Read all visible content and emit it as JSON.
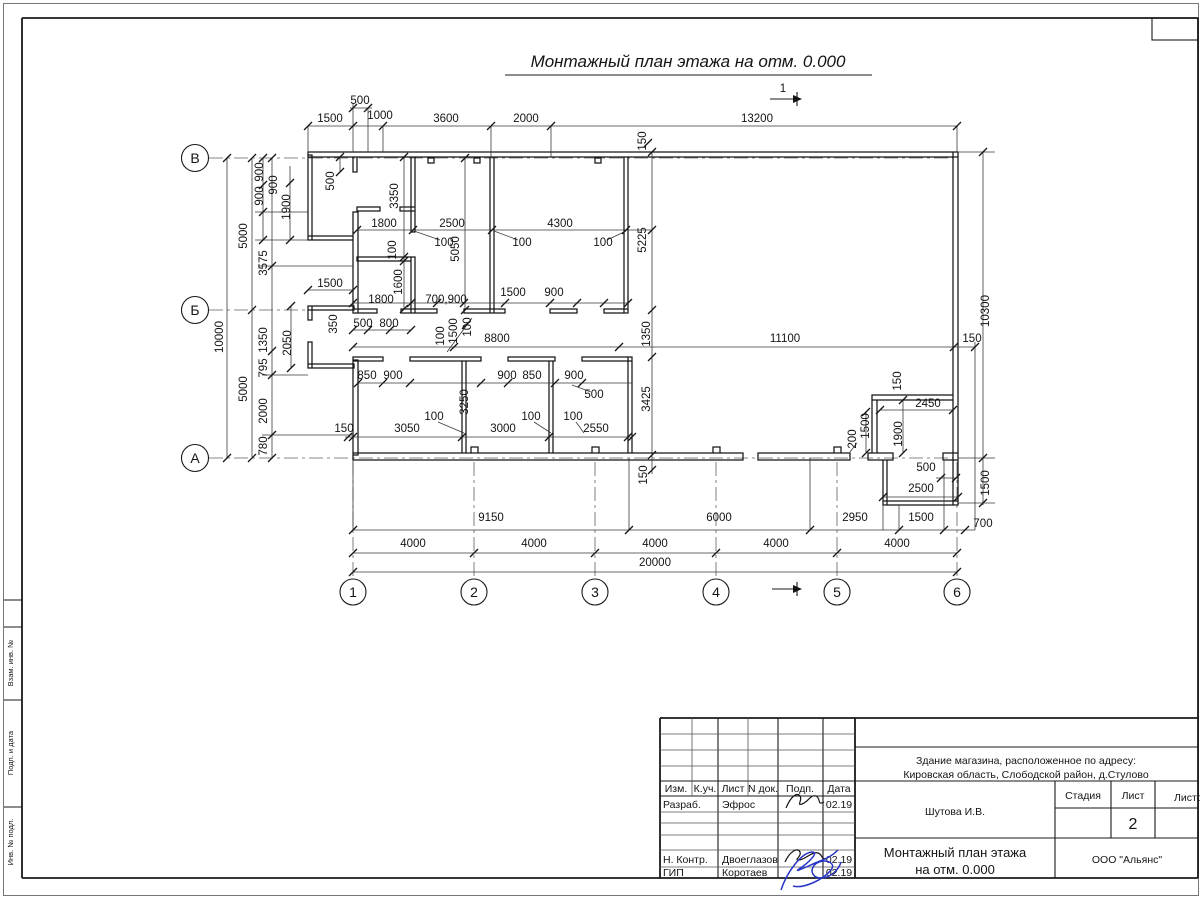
{
  "sheet": {
    "title": "Монтажный план этажа на отм. 0.000",
    "section_mark": "1"
  },
  "axes": {
    "rows": [
      "В",
      "Б",
      "А"
    ],
    "cols": [
      "1",
      "2",
      "3",
      "4",
      "5",
      "6"
    ]
  },
  "dims": {
    "top": [
      "500",
      "1500",
      "1000",
      "3600",
      "2000",
      "13200",
      "150"
    ],
    "left": [
      "900",
      "900",
      "900",
      "1900",
      "5000",
      "3575",
      "10000",
      "1350",
      "2050",
      "795",
      "5000",
      "2000",
      "780"
    ],
    "upper": [
      "500",
      "3350",
      "1800",
      "2500",
      "100",
      "4300",
      "100",
      "100",
      "5050",
      "5225",
      "100",
      "1600",
      "1500",
      "350",
      "500",
      "800",
      "1800",
      "700,900",
      "1500",
      "900",
      "100",
      "1500",
      "100"
    ],
    "mid": [
      "8800",
      "11100",
      "150",
      "1350",
      "10300"
    ],
    "lower": [
      "850",
      "900",
      "900",
      "850",
      "900",
      "500",
      "3250",
      "150",
      "3050",
      "100",
      "3000",
      "100",
      "100",
      "2550",
      "3425",
      "150"
    ],
    "dock": [
      "150",
      "2450",
      "1500",
      "200",
      "1900",
      "500",
      "2500",
      "1500"
    ],
    "bottom": [
      "9150",
      "6000",
      "2950",
      "1500",
      "700",
      "4000",
      "4000",
      "4000",
      "4000",
      "4000",
      "20000"
    ]
  },
  "titleblock": {
    "cols": [
      "Изм.",
      "К.уч.",
      "Лист",
      "N док.",
      "Подп.",
      "Дата"
    ],
    "row_razrab": {
      "role": "Разраб.",
      "name": "Эфрос",
      "date": "02.19"
    },
    "row_nkontr": {
      "role": "Н. Контр.",
      "name": "Двоеглазов",
      "date": "02.19"
    },
    "row_gip": {
      "role": "ГИП",
      "name": "Коротаев",
      "date": "02.19"
    },
    "object_line1": "Здание магазина, расположенное по адресу:",
    "object_line2": "Кировская область, Слободской район, д.Стулово",
    "designer": "Шутова И.В.",
    "stage_label": "Стадия",
    "sheet_label": "Лист",
    "sheets_label": "Листов",
    "sheet_number": "2",
    "doc_line1": "Монтажный план этажа",
    "doc_line2": "на отм. 0.000",
    "company": "ООО \"Альянс\""
  },
  "side_stamp": {
    "cells": [
      "Взам. инв. №",
      "Подп. и дата",
      "Инв. № подл."
    ]
  }
}
